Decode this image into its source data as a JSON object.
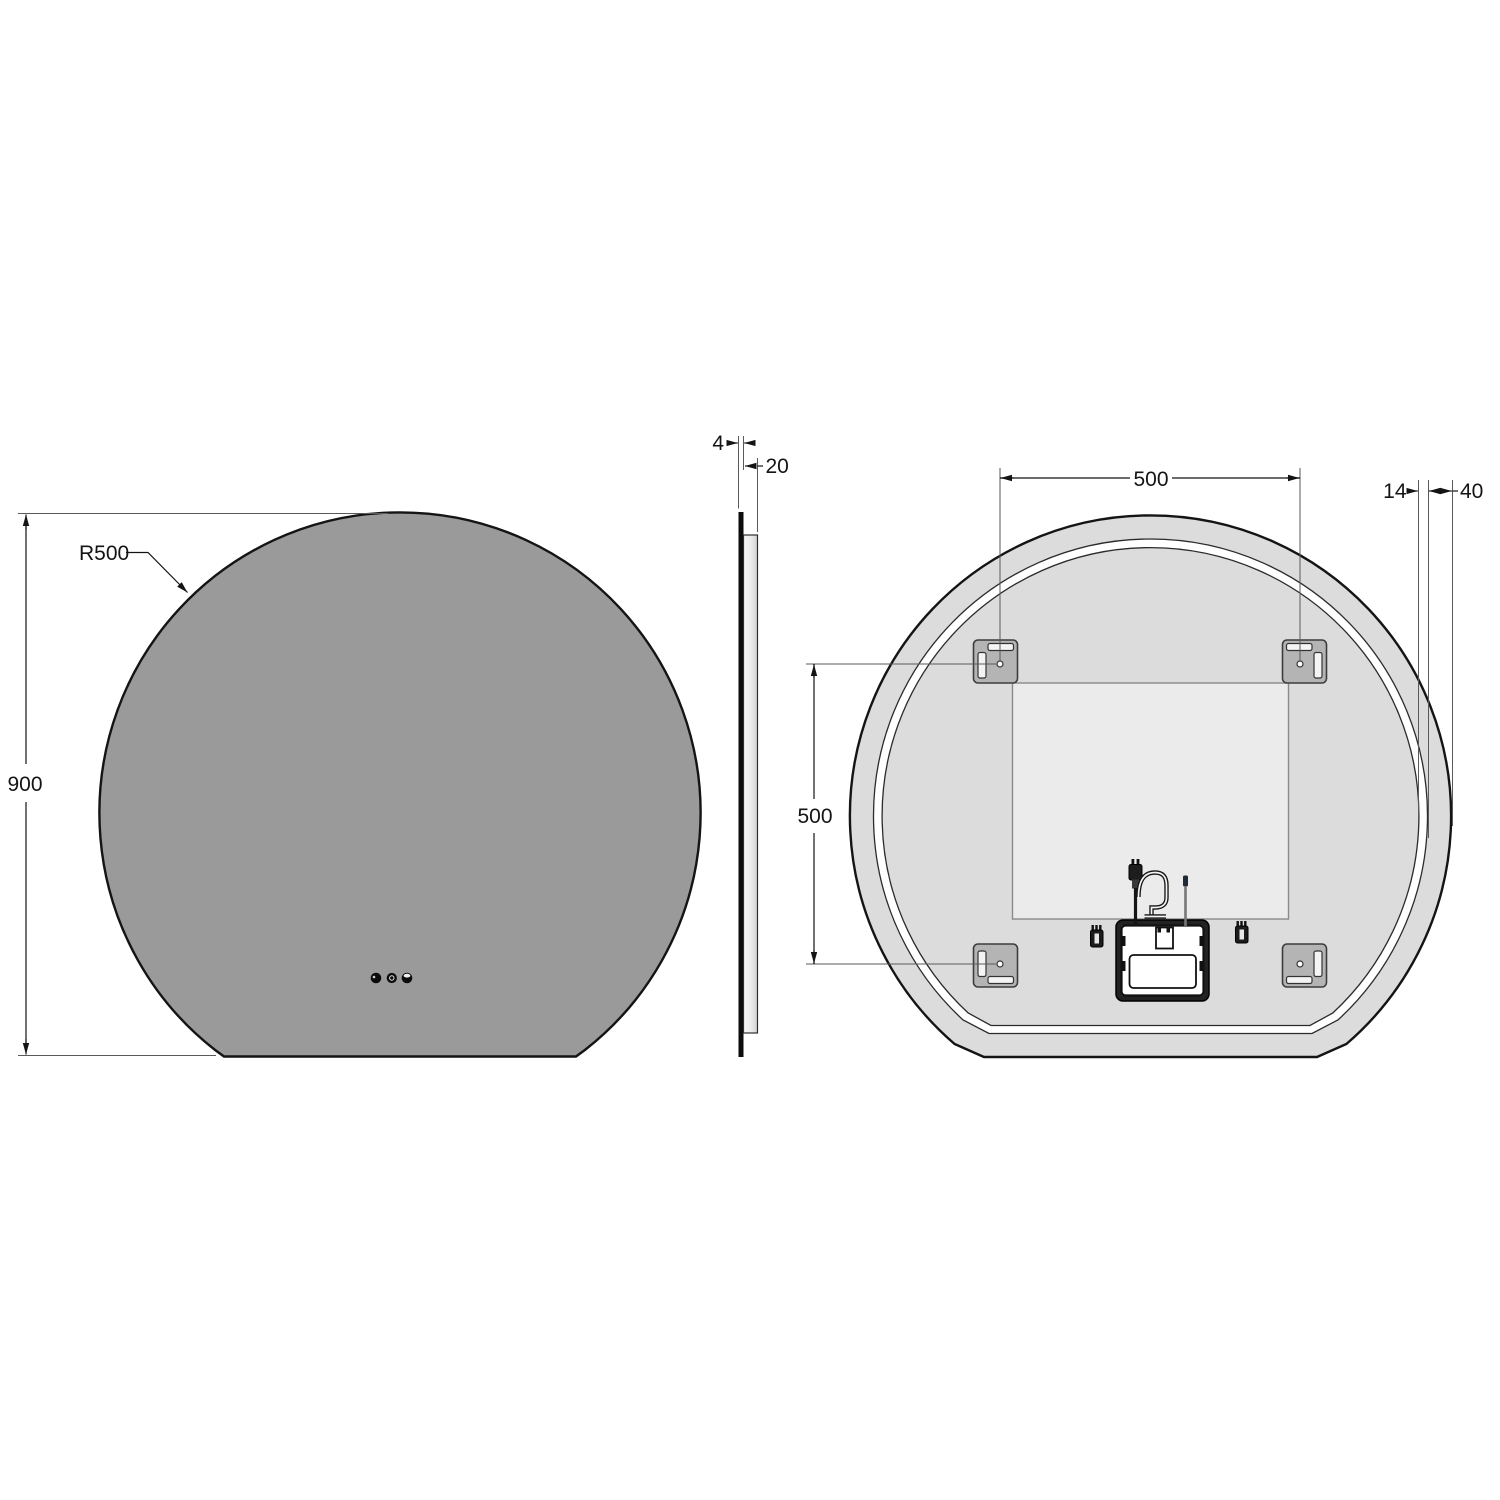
{
  "drawing": {
    "title": "Round LED mirror with flat bottom — dimensional drawing (front, side and back views)",
    "units": "mm",
    "front_view": {
      "name": "front view",
      "radius_label": "R500",
      "height_label": "900",
      "touch_button_count": 3
    },
    "side_view": {
      "name": "side profile view",
      "glass_thickness_label": "4",
      "depth_label": "20"
    },
    "back_view": {
      "name": "back view",
      "bracket_spacing_horizontal_label": "500",
      "bracket_spacing_vertical_label": "500",
      "led_band_width_label": "14",
      "rim_width_label": "40",
      "bracket_count": 4
    },
    "colors": {
      "background": "#ffffff",
      "mirror_face": "#9a9a9a",
      "back_body": "#dcdcdc",
      "back_panel": "#ebebeb",
      "bracket": "#b4b4b4",
      "line": "#141414"
    }
  }
}
